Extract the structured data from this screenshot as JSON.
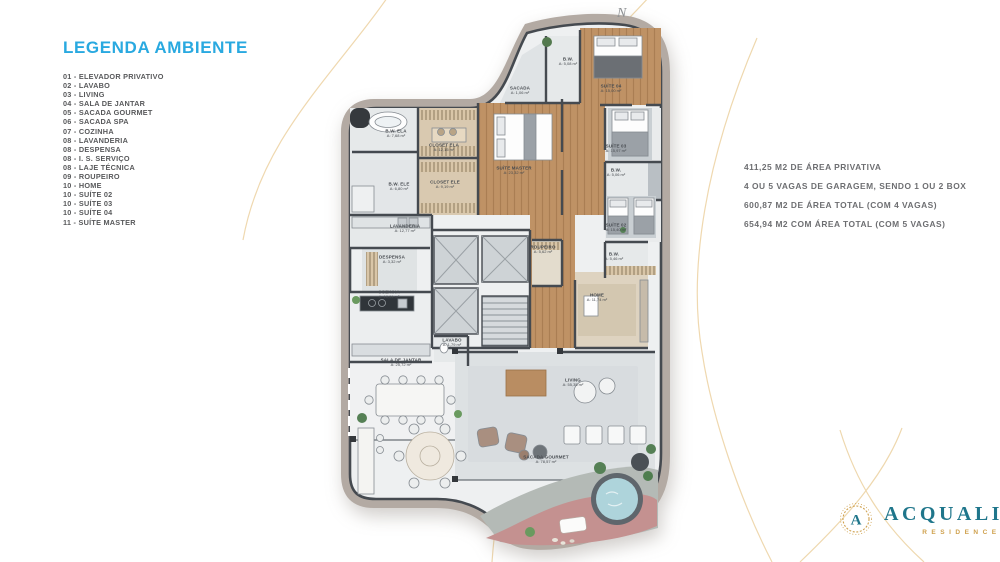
{
  "colors": {
    "accent_cyan": "#29a9e0",
    "text_gray": "#58595b",
    "info_gray": "#6d6e71",
    "logo_teal": "#1f768b",
    "logo_gold": "#cfa14e",
    "arc_gold": "#e9cb94",
    "plan_band": "#b3aaa3",
    "wood": "#bf9265",
    "deck_pink": "#c49190",
    "pool_blue": "#aed4db"
  },
  "legend": {
    "title": "LEGENDA AMBIENTE",
    "items": [
      "01 - ELEVADOR PRIVATIVO",
      "02 - LAVABO",
      "03 - LIVING",
      "04 - SALA DE JANTAR",
      "05 - SACADA GOURMET",
      "06 - SACADA SPA",
      "07 - COZINHA",
      "08 - LAVANDERIA",
      "08 - DESPENSA",
      "08 - I. S. SERVIÇO",
      "08 - LAJE TÉCNICA",
      "09 - ROUPEIRO",
      "10 - HOME",
      "10 - SUÍTE 02",
      "10 - SUÍTE 03",
      "10 - SUÍTE 04",
      "11 - SUÍTE MASTER"
    ]
  },
  "info": {
    "lines": [
      "411,25 M2  DE ÁREA PRIVATIVA",
      "4 OU 5 VAGAS DE GARAGEM, SENDO 1 OU 2 BOX",
      "600,87 M2 DE ÁREA TOTAL (COM 4 VAGAS)",
      "654,94 M2 COM ÁREA TOTAL (COM 5 VAGAS)"
    ]
  },
  "compass": {
    "label": "N"
  },
  "floorplan": {
    "rooms": [
      {
        "id": "bw-top",
        "name": "B.W.",
        "area": "A: 5,08 m²"
      },
      {
        "id": "sacada",
        "name": "SACADA",
        "area": "A: 1,06 m²"
      },
      {
        "id": "suite-04",
        "name": "SUÍTE 04",
        "area": "A: 15,00 m²"
      },
      {
        "id": "suite-master",
        "name": "SUÍTE MASTER",
        "area": "A: 23,32 m²"
      },
      {
        "id": "closet-ela",
        "name": "CLOSET ELA",
        "area": "A: 12,15 m²"
      },
      {
        "id": "closet-ele",
        "name": "CLOSET ELE",
        "area": "A: 9,19 m²"
      },
      {
        "id": "bw-ela",
        "name": "B.W. ELA",
        "area": "A: 7,68 m²"
      },
      {
        "id": "bw-ele",
        "name": "B.W. ELE",
        "area": "A: 6,80 m²"
      },
      {
        "id": "suite-03",
        "name": "SUÍTE 03",
        "area": "A: 15,97 m²"
      },
      {
        "id": "bw-suite-03",
        "name": "B.W.",
        "area": "A: 5,06 m²"
      },
      {
        "id": "suite-02",
        "name": "SUÍTE 02",
        "area": "A: 15,40 m²"
      },
      {
        "id": "bw-suite-02",
        "name": "B.W.",
        "area": "A: 5,46 m²"
      },
      {
        "id": "roupeiro",
        "name": "ROUPEIRO",
        "area": "A: 5,62 m²"
      },
      {
        "id": "home",
        "name": "HOME",
        "area": "A: 11,74 m²"
      },
      {
        "id": "lavanderia",
        "name": "LAVANDERIA",
        "area": "A: 12,77 m²"
      },
      {
        "id": "despensa",
        "name": "DESPENSA",
        "area": "A: 3,32 m²"
      },
      {
        "id": "cozinha",
        "name": "COZINHA",
        "area": "A: 18,61 m²"
      },
      {
        "id": "lavabo",
        "name": "LAVABO",
        "area": "A: 1,79 m²"
      },
      {
        "id": "sala-de-jantar",
        "name": "SALA DE JANTAR",
        "area": "A: 25,72 m²"
      },
      {
        "id": "living",
        "name": "LIVING",
        "area": "A: 55,35 m²"
      },
      {
        "id": "sacada-gourmet",
        "name": "SACADA GOURMET",
        "area": "A: 78,57 m²"
      }
    ]
  },
  "logo": {
    "monogram": "A",
    "name": "ACQUALINA",
    "subtitle": "RESIDENCE"
  }
}
